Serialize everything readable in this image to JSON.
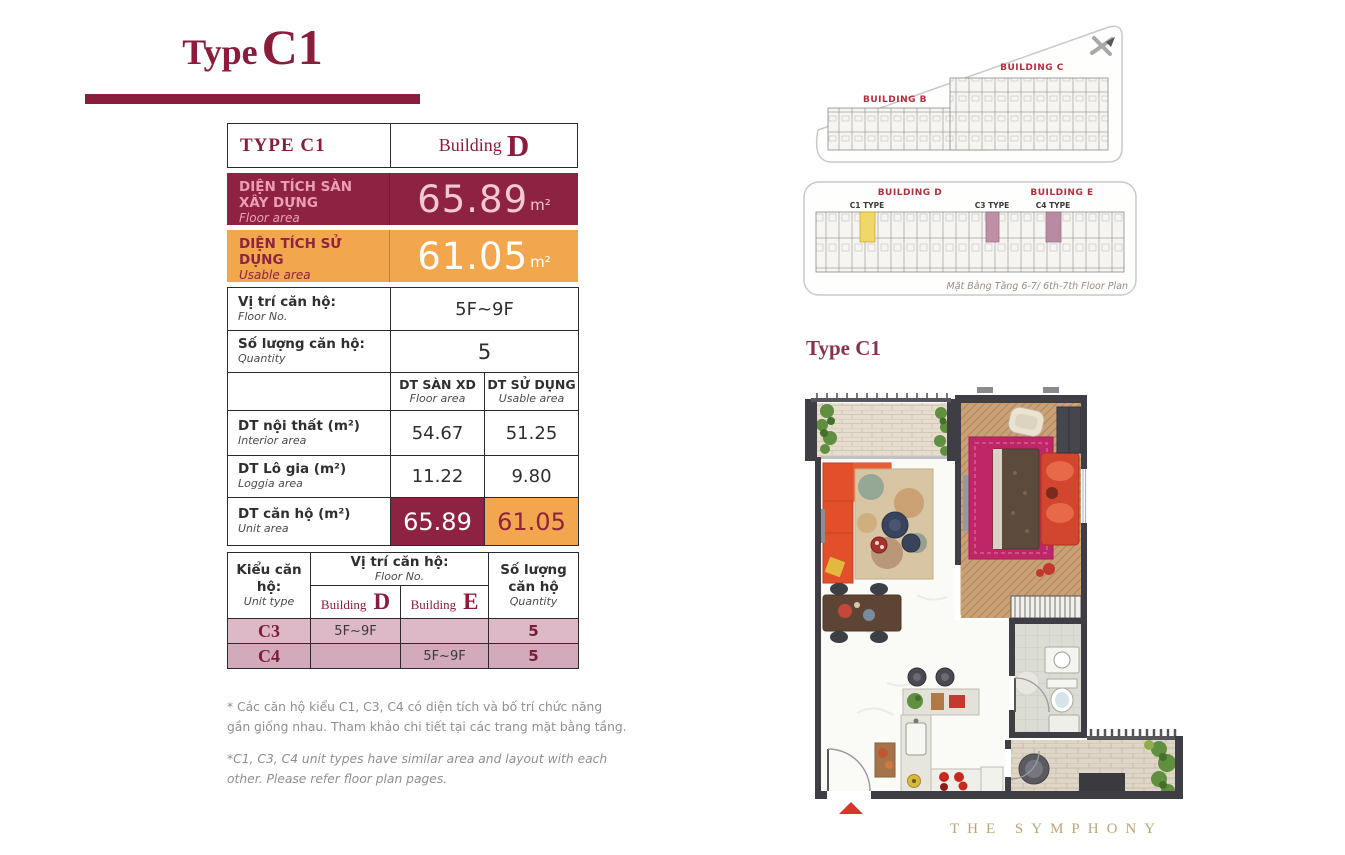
{
  "page": {
    "title_prefix": "Type",
    "title_code": "C1"
  },
  "colors": {
    "maroon": "#8E2242",
    "orange": "#F2A64E",
    "row_c3_pink": "#DDB9C8",
    "row_c4_pink": "#D3A9BC",
    "highlight_yellow": "#EFD867",
    "highlight_mauve": "#C08FA6",
    "brand_gold": "#B9A578"
  },
  "spec": {
    "header": {
      "type": "TYPE C1",
      "building_word": "Building",
      "building_letter": "D"
    },
    "floor_area": {
      "vi": "DIỆN TÍCH SÀN XÂY DỰNG",
      "en": "Floor area",
      "value": "65.89",
      "unit": "m²"
    },
    "usable_area": {
      "vi": "DIỆN TÍCH SỬ DỤNG",
      "en": "Usable area",
      "value": "61.05",
      "unit": "m²"
    }
  },
  "detail": {
    "floor_no": {
      "vi": "Vị trí căn hộ:",
      "en": "Floor No.",
      "value": "5F~9F"
    },
    "quantity": {
      "vi": "Số lượng căn hộ:",
      "en": "Quantity",
      "value": "5"
    },
    "col1": {
      "vi": "DT SÀN XD",
      "en": "Floor area"
    },
    "col2": {
      "vi": "DT SỬ DỤNG",
      "en": "Usable area"
    },
    "rows": [
      {
        "vi": "DT nội thất (m²)",
        "en": "Interior area",
        "v1": "54.67",
        "v2": "51.25"
      },
      {
        "vi": "DT Lô gia (m²)",
        "en": "Loggia area",
        "v1": "11.22",
        "v2": "9.80"
      },
      {
        "vi": "DT căn hộ (m²)",
        "en": "Unit area",
        "v1": "65.89",
        "v2": "61.05"
      }
    ]
  },
  "unit_table": {
    "col_type": {
      "vi": "Kiểu căn hộ:",
      "en": "Unit type"
    },
    "floor": {
      "vi": "Vị trí căn hộ:",
      "en": "Floor No."
    },
    "qty": {
      "vi": "Số lượng căn hộ",
      "en": "Quantity"
    },
    "building_d": {
      "word": "Building",
      "letter": "D"
    },
    "building_e": {
      "word": "Building",
      "letter": "E"
    },
    "rows": [
      {
        "type": "C3",
        "d": "5F~9F",
        "e": "",
        "qty": "5"
      },
      {
        "type": "C4",
        "d": "",
        "e": "5F~9F",
        "qty": "5"
      }
    ]
  },
  "footnotes": {
    "vi": "* Các căn hộ kiểu C1, C3, C4 có diện tích và bố trí chức năng gần giống nhau. Tham khảo chi tiết tại các trang mặt bằng tầng.",
    "en": "*C1, C3, C4 unit types have similar area and layout with each other. Please refer floor plan pages."
  },
  "site_plans": {
    "plan1": {
      "building_b": "BUILDING B",
      "building_c": "BUILDING C"
    },
    "plan2": {
      "building_d": "BUILDING D",
      "building_e": "BUILDING E",
      "c1_label": "C1 TYPE",
      "c3_label": "C3 TYPE",
      "c4_label": "C4 TYPE",
      "caption": "Mặt Bằng Tầng 6-7/ 6th-7th Floor Plan"
    }
  },
  "plan_section": {
    "label": "Type C1",
    "brand": "THE SYMPHONY"
  }
}
